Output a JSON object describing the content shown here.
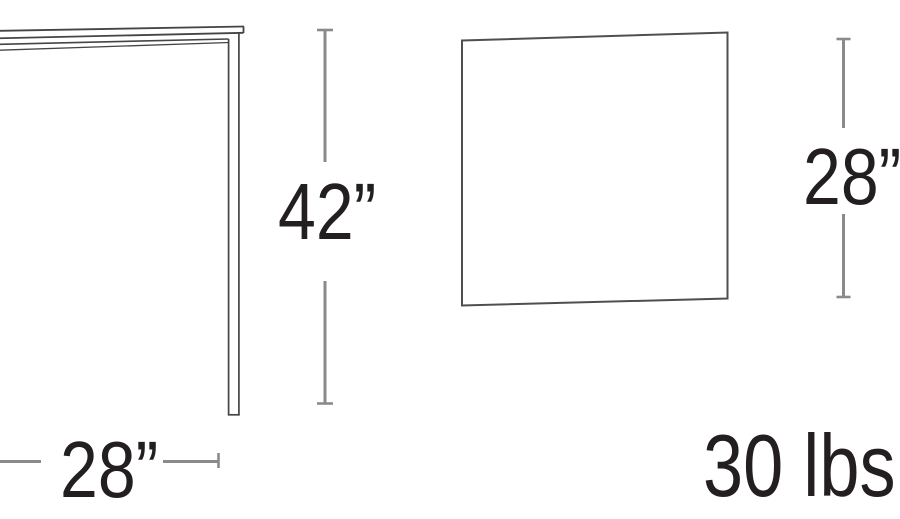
{
  "labels": {
    "height": "42”",
    "width": "28”",
    "depth": "28”",
    "weight": "30 lbs"
  },
  "colors": {
    "background": "#ffffff",
    "drawing_line": "#454545",
    "top_view_outline": "#4f4f4f",
    "dimension_line": "#8a8a8a",
    "text": "#231f20"
  }
}
